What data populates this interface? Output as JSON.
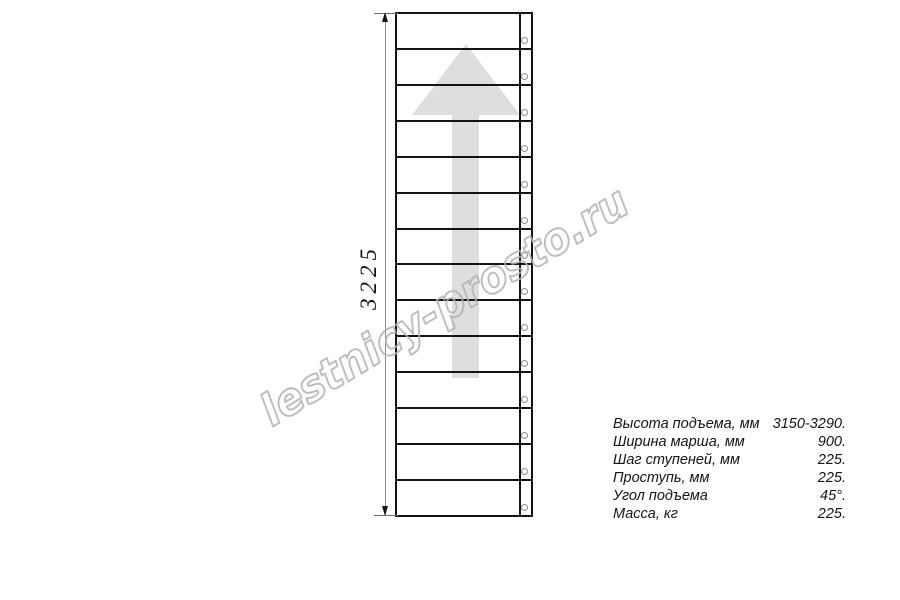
{
  "drawing": {
    "dimension_label": "3225",
    "steps_count": 14,
    "line_color": "#141414",
    "arrow_color": "#dedede"
  },
  "watermark": {
    "text": "lestnicy-prosto.ru",
    "color": "#b3b3b3"
  },
  "specs": {
    "rows": [
      {
        "label": "Высота подъема, мм",
        "value": "3150-3290."
      },
      {
        "label": "Ширина марша, мм",
        "value": "900."
      },
      {
        "label": "Шаг ступеней, мм",
        "value": "225."
      },
      {
        "label": "Проступь, мм",
        "value": "225."
      },
      {
        "label": "Угол подъема",
        "value": "45°."
      },
      {
        "label": "Масса, кг",
        "value": "225."
      }
    ]
  }
}
